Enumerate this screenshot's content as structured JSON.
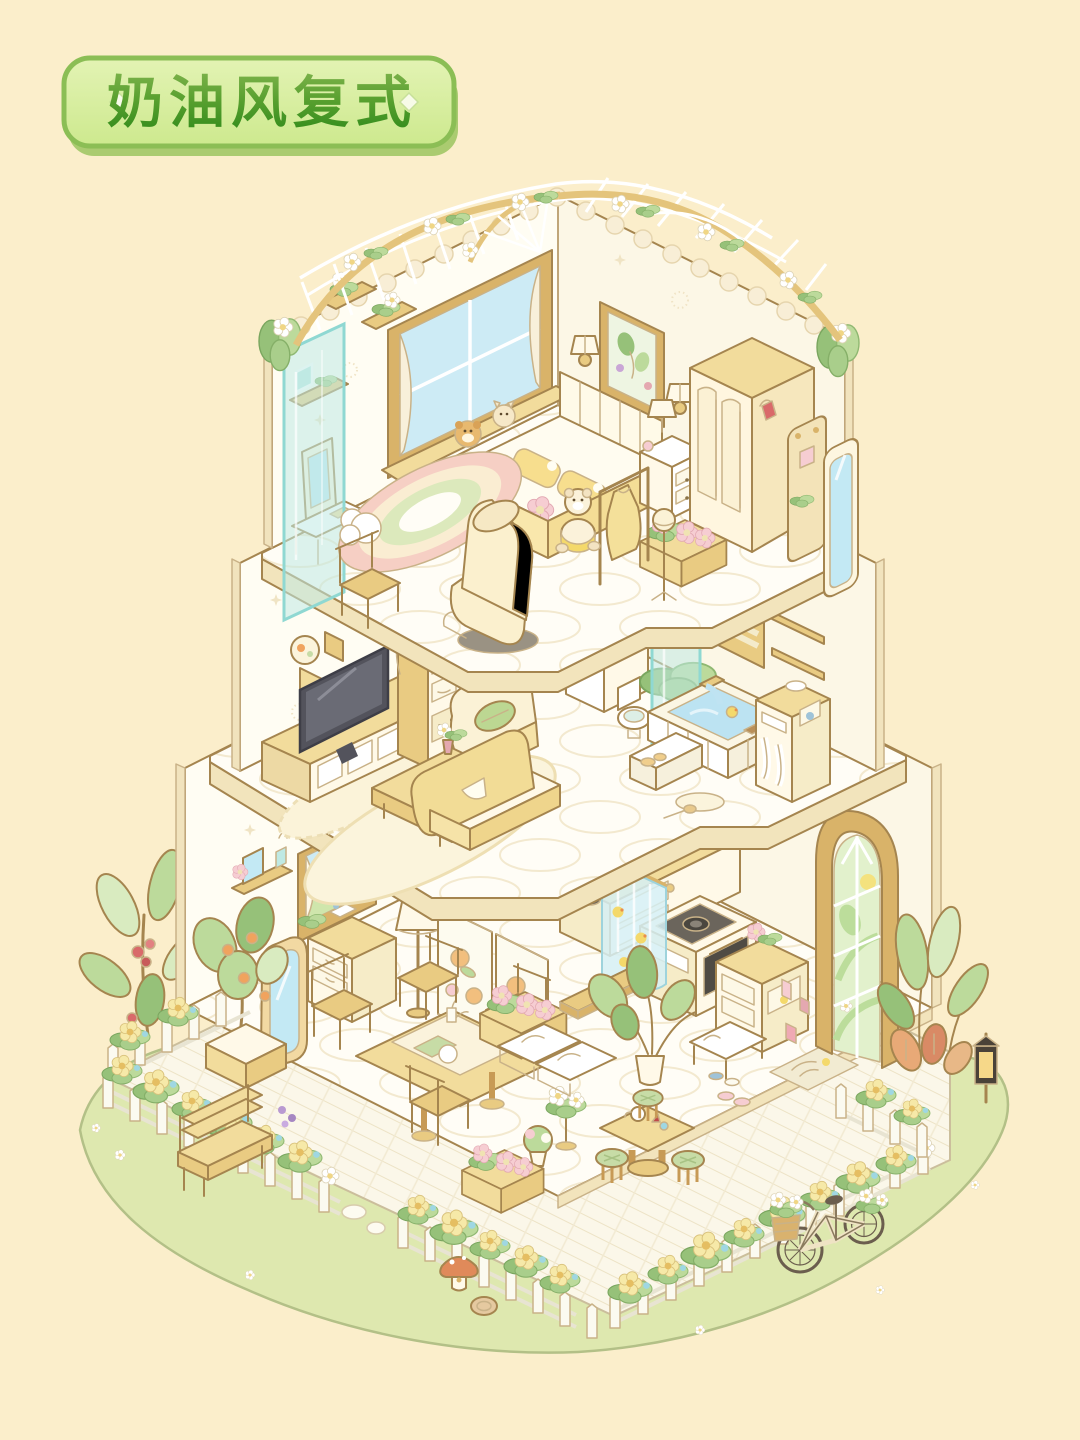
{
  "badge": {
    "label": "奶油风复式"
  },
  "palette": {
    "bg": "#FBEECB",
    "ink": "#A5854F",
    "wall": "#FFFDF3",
    "edge": "#F1E3BD",
    "wood": "#F2DC9C",
    "teal": "#BFE9E3",
    "sky": "#CDEBF5",
    "leaf": "#BCDA9B",
    "yellow": "#F6E1A0",
    "pink": "#F6CDD2",
    "grass": "#DEE8AF",
    "badgeFill": "#D8EFA0",
    "badgeBorder": "#8BBE55",
    "badgeTextTop": "#7CB24A",
    "badgeTextBottom": "#2F8A1A"
  },
  "scene": {
    "style": "cream pastel isometric cutaway duplex dollhouse",
    "floors": [
      {
        "name": "top floor bedroom",
        "items": [
          "flower trellis roof",
          "hanging corner plants",
          "bay window with plush toys",
          "curtains",
          "wall art",
          "wall sconces",
          "bed with yellow pillows",
          "nightstand with lamp",
          "wardrobe",
          "peg rack with bag",
          "standing mirror",
          "flower crate",
          "clothes rack with dress",
          "hat stand",
          "teddy bear",
          "rainbow cloud rug",
          "massage chair",
          "vanity behind glass panel",
          "wooden chair"
        ]
      },
      {
        "name": "middle floor living room and bathroom",
        "items": [
          "wall plates and frames",
          "TV on console",
          "bookshelf with vine",
          "glass partition",
          "armchair with leaf pillow",
          "coffee table with vase",
          "oval rug",
          "yellow sofa",
          "bathroom sink with mirror",
          "toilet",
          "sunken bathtub with duck",
          "bath steps",
          "window blinds",
          "toiletry shelf",
          "towel cabinet",
          "potted plant",
          "bath mat",
          "bath brush"
        ]
      },
      {
        "name": "ground floor dining and kitchen",
        "items": [
          "wall shelf with mirror and tulip",
          "window with curtains",
          "standing wavy mirror",
          "dresser",
          "floor lamp",
          "floral folding screen",
          "potted orange tree",
          "dining table with four chairs",
          "flower crates",
          "kitchen counter with utensils",
          "gas stove and oven",
          "duck print curtain",
          "low wooden board",
          "big potted plant",
          "shoe cabinet",
          "shoe bench",
          "slippers",
          "leaf door mat",
          "arched garden door",
          "tea table with kettle",
          "green stools",
          "white bench cushions",
          "flower stand"
        ]
      }
    ],
    "garden": {
      "items": [
        "grass lawn",
        "white picket fence with yellow flowers",
        "wooden bench",
        "stepping stones",
        "mushroom house",
        "log slice",
        "lantern",
        "large leafy plants",
        "red berry plant",
        "bicycle with flower baskets",
        "plank patio"
      ]
    }
  }
}
